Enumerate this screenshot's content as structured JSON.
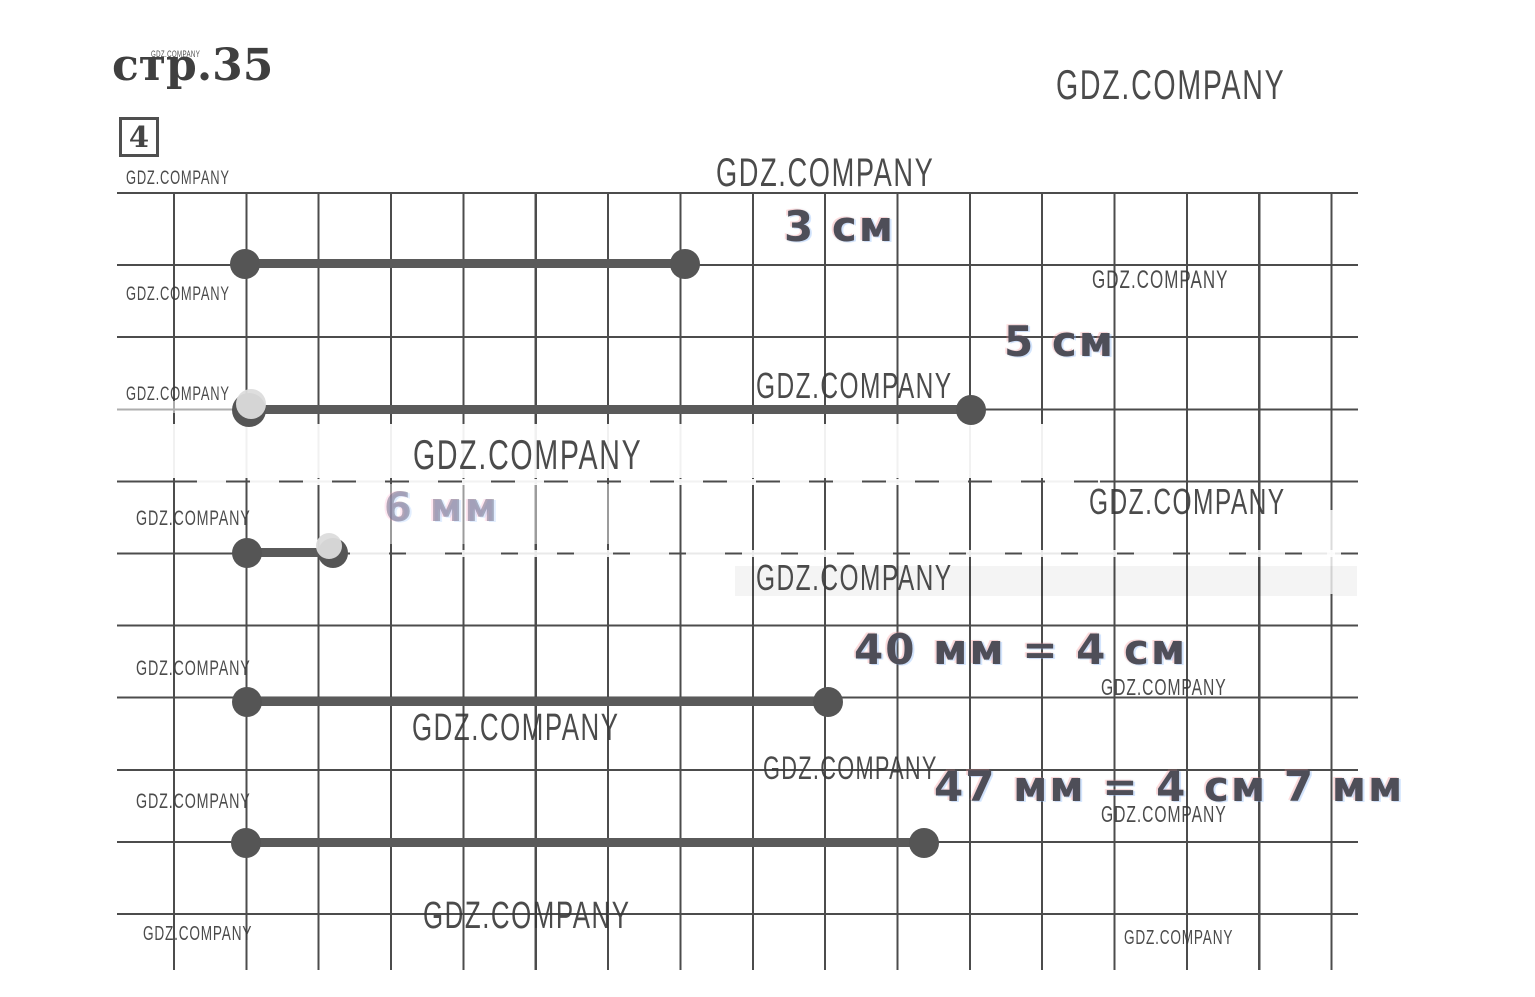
{
  "page": {
    "title_page_ref": "стр.35",
    "exercise_number": "4",
    "watermark": "GDZ.COMPANY"
  },
  "measurements": {
    "items": [
      {
        "label": "3 см"
      },
      {
        "label": "5 см"
      },
      {
        "label": "6 мм"
      },
      {
        "label": "40 мм = 4 см"
      },
      {
        "label": "47 мм = 4 см 7 мм"
      }
    ]
  }
}
